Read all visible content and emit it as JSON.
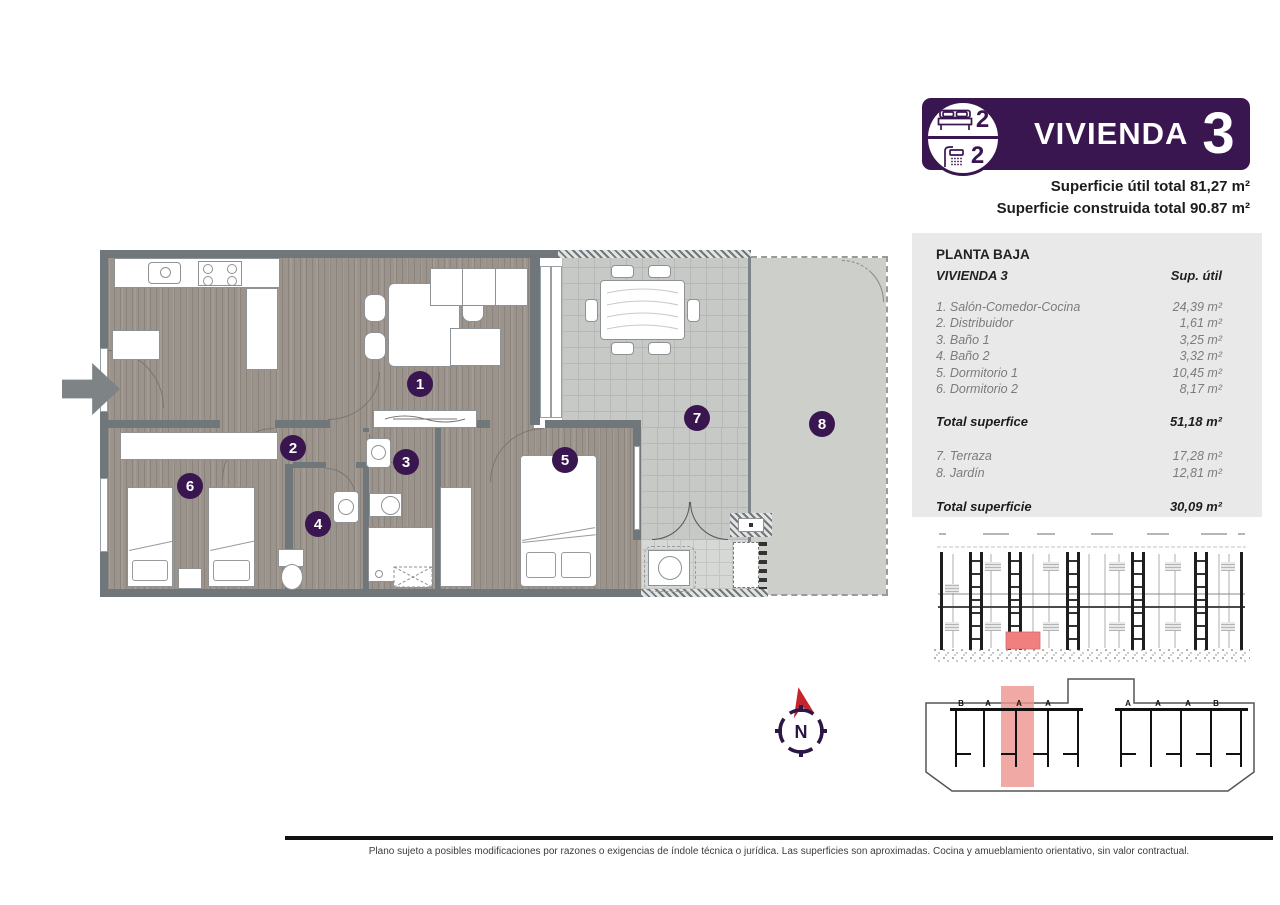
{
  "header": {
    "badge": {
      "bedrooms": "2",
      "bathrooms": "2",
      "title": "VIVIENDA",
      "number": "3"
    },
    "superficie_util": "Superficie útil total 81,27 m²",
    "superficie_construida": "Superficie construida total 90.87 m²"
  },
  "table": {
    "floor": "PLANTA BAJA",
    "unit": "VIVIENDA 3",
    "col_header": "Sup. útil",
    "rooms": [
      {
        "label": "1. Salón-Comedor-Cocina",
        "value": "24,39 m²"
      },
      {
        "label": "2. Distribuidor",
        "value": "1,61 m²"
      },
      {
        "label": "3. Baño 1",
        "value": "3,25 m²"
      },
      {
        "label": "4. Baño 2",
        "value": "3,32 m²"
      },
      {
        "label": "5. Dormitorio 1",
        "value": "10,45 m²"
      },
      {
        "label": "6. Dormitorio 2",
        "value": "8,17 m²"
      }
    ],
    "total_interior": {
      "label": "Total superfice",
      "value": "51,18 m²"
    },
    "exterior": [
      {
        "label": "7. Terraza",
        "value": "17,28 m²"
      },
      {
        "label": "8. Jardín",
        "value": "12,81 m²"
      }
    ],
    "total_exterior": {
      "label": "Total superficie",
      "value": "30,09 m²"
    }
  },
  "plan": {
    "room_numbers": [
      "1",
      "2",
      "3",
      "4",
      "5",
      "6",
      "7",
      "8"
    ]
  },
  "compass": {
    "label": "N"
  },
  "site_plan": {
    "letters_left": [
      "B",
      "A",
      "A",
      "A"
    ],
    "letters_right": [
      "A",
      "A",
      "A",
      "B"
    ]
  },
  "footer": {
    "disclaimer": "Plano sujeto a posibles modificaciones por razones o exigencias de índole técnica o jurídica. Las superficies son aproximadas. Cocina y amueblamiento orientativo, sin valor contractual."
  },
  "colors": {
    "purple": "#3A1650",
    "compass_red": "#C4242C",
    "highlight_red": "#F08080",
    "wall_gray": "#6F777A"
  }
}
